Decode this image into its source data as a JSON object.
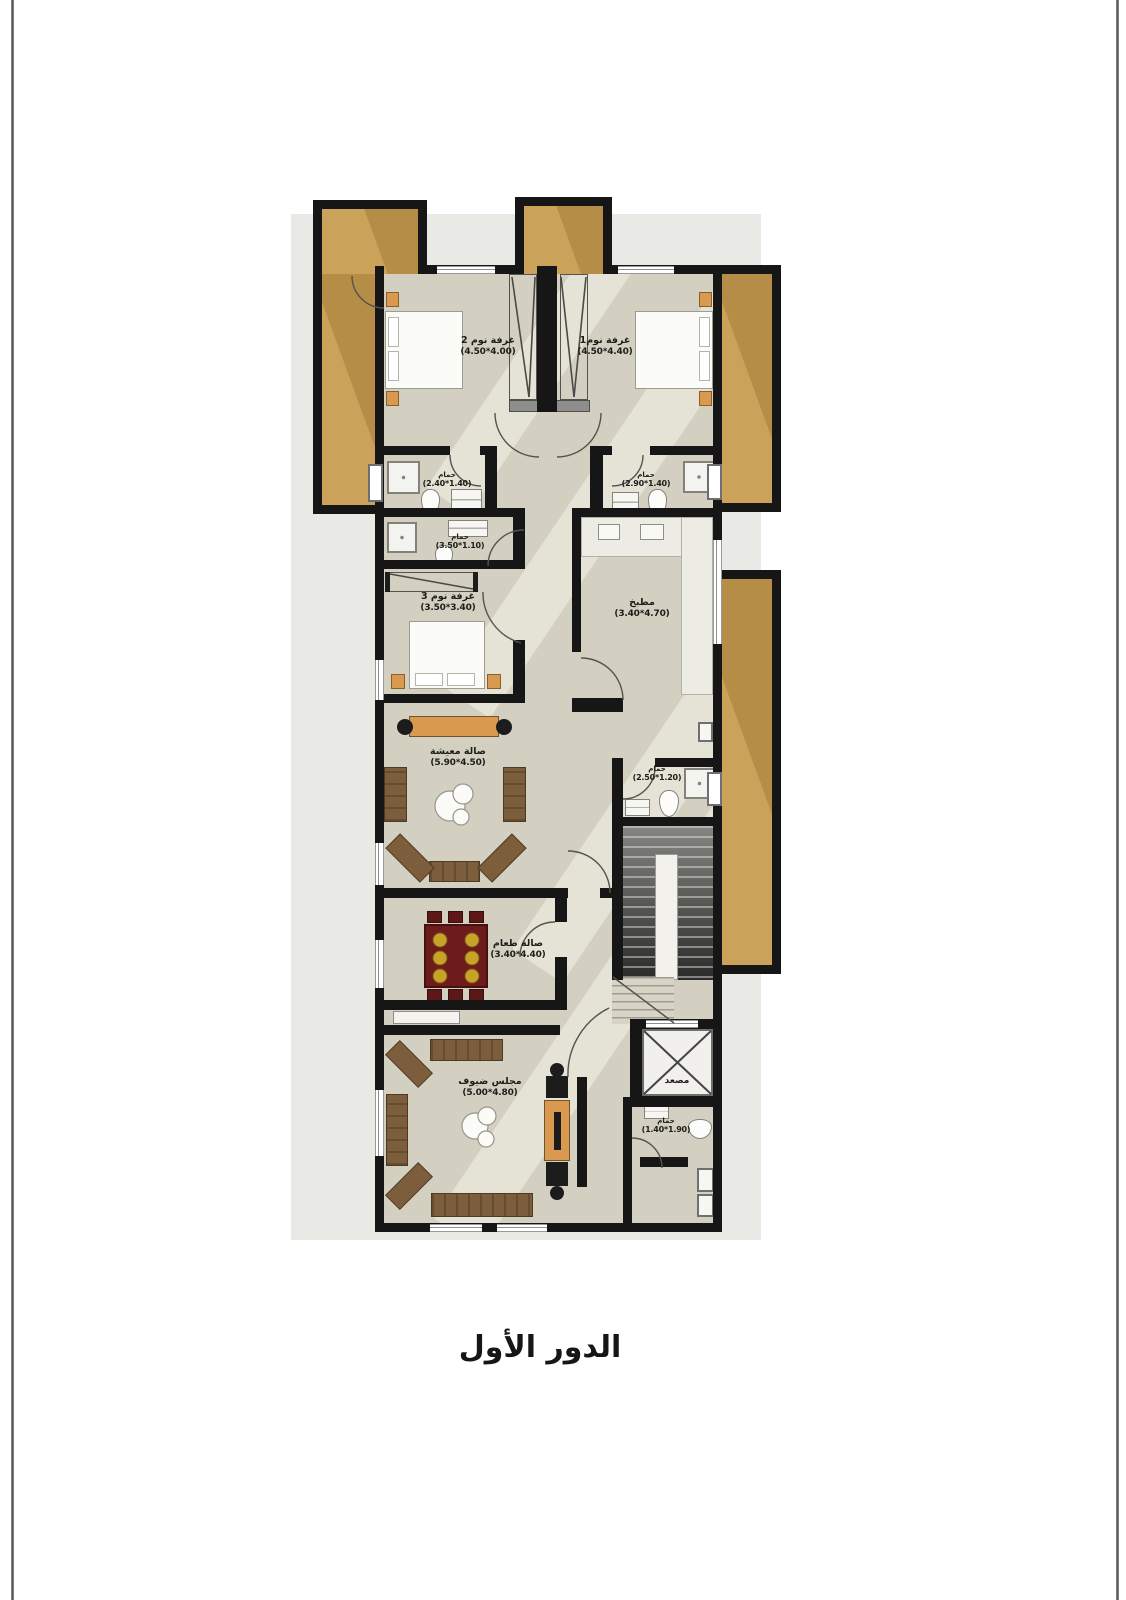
{
  "title": "الدور الأول",
  "rooms": {
    "bedroom2": {
      "name": "غرفة نوم 2",
      "dims": "(4.50*4.00)"
    },
    "bedroom1": {
      "name": "غرفة نوم1",
      "dims": "(4.50*4.40)"
    },
    "bath_master_left": {
      "name": "حمام",
      "dims": "(2.40*1.40)"
    },
    "bath_master_right": {
      "name": "حمام",
      "dims": "(2.90*1.40)"
    },
    "bath_mid": {
      "name": "حمام",
      "dims": "(3.50*1.10)"
    },
    "bedroom3": {
      "name": "غرفة نوم 3",
      "dims": "(3.50*3.40)"
    },
    "kitchen": {
      "name": "مطبخ",
      "dims": "(3.40*4.70)"
    },
    "living": {
      "name": "صالة معيشة",
      "dims": "(5.90*4.50)"
    },
    "bath_hall": {
      "name": "حمام",
      "dims": "(2.50*1.20)"
    },
    "dining": {
      "name": "صالة طعام",
      "dims": "(3.40*4.40)"
    },
    "majlis": {
      "name": "مجلس ضيوف",
      "dims": "(5.00*4.80)"
    },
    "elevator": {
      "name": "مصعد"
    },
    "bath_guest": {
      "name": "حمام",
      "dims": "(1.40*1.90)"
    }
  },
  "colors": {
    "wall": "#161616",
    "floor": "#d3d0c1",
    "balcony": "#bf964f",
    "wood_accent": "#d9994e",
    "dining_table": "#6e1b1b"
  }
}
